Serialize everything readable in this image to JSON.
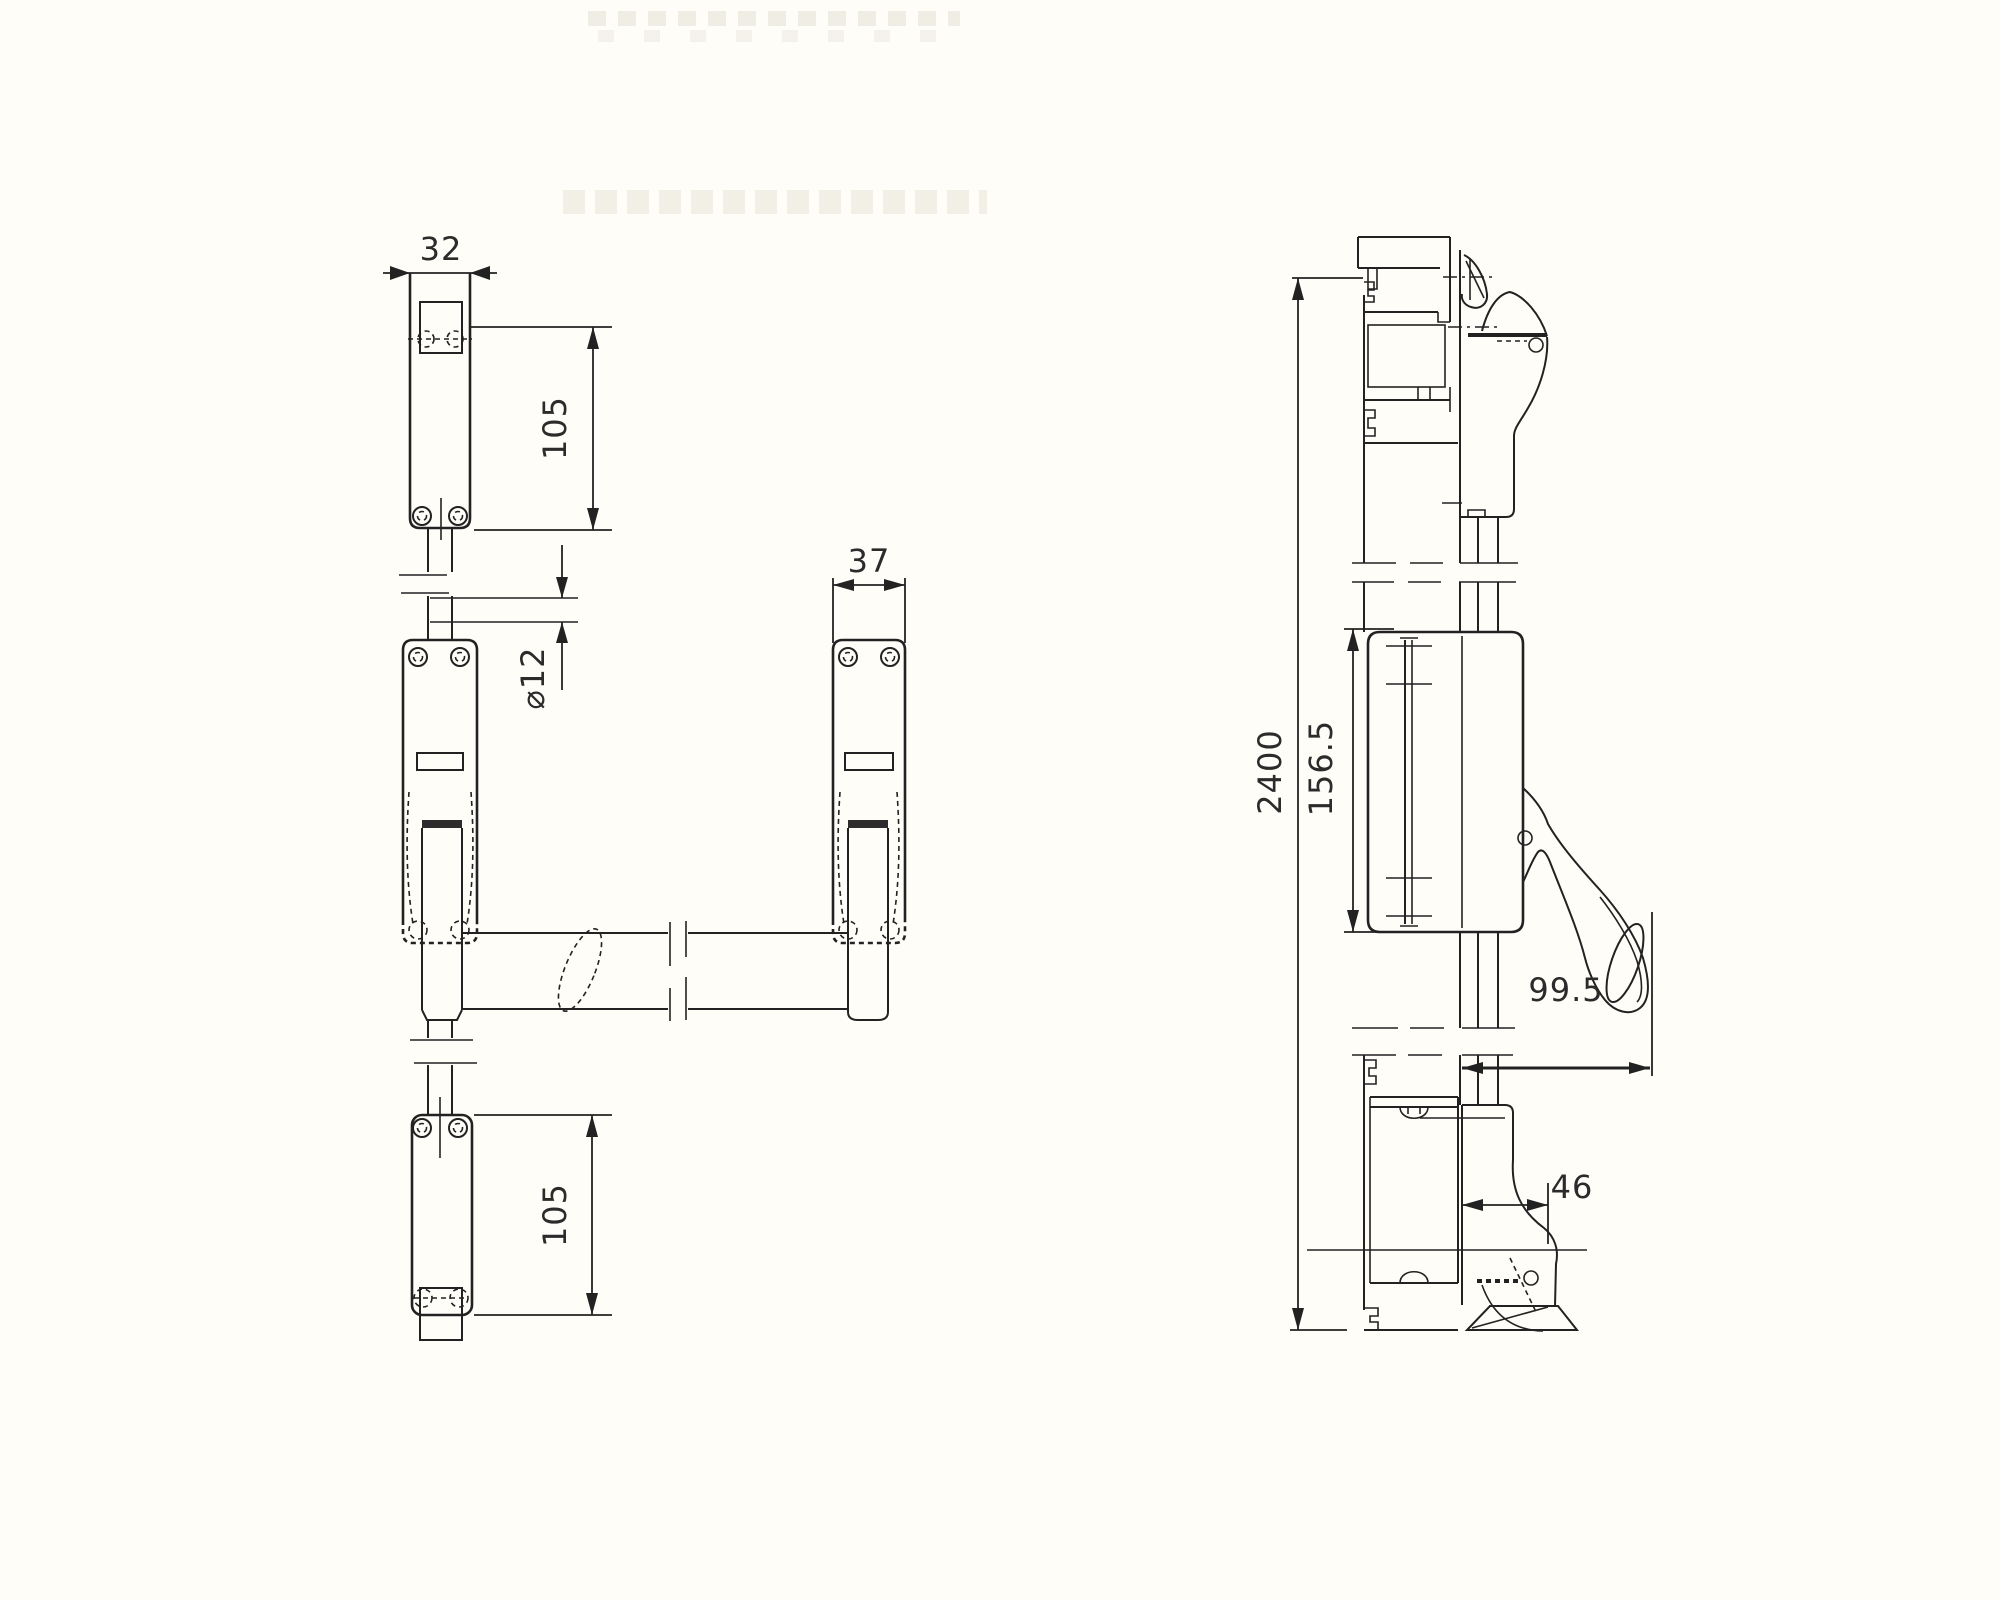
{
  "drawing": {
    "type": "technical-drawing",
    "subject": "panic-exit-device-with-vertical-rods",
    "front_view": {
      "dim_top_plate_width": "32",
      "dim_top_plate_height": "105",
      "dim_rod_diameter": "⌀12",
      "dim_handle_plate_width": "37",
      "dim_bottom_plate_height": "105"
    },
    "side_view": {
      "dim_overall_height": "2400",
      "dim_lock_body_height": "156.5",
      "dim_handle_projection": "99.5",
      "dim_bottom_projection": "46"
    }
  }
}
